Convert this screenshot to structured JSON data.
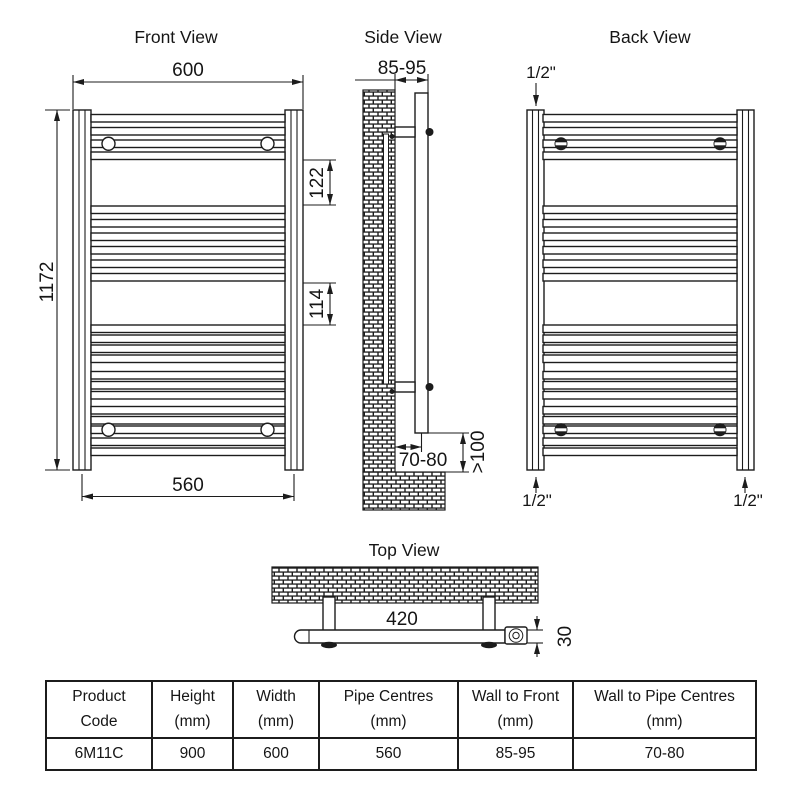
{
  "colors": {
    "line": "#1c1c1c",
    "background": "#ffffff"
  },
  "front_view": {
    "title": "Front View",
    "width_mm": "600",
    "height_mm": "1172",
    "upper_gap_mm": "122",
    "lower_gap_mm": "114",
    "pipe_centres_mm": "560"
  },
  "side_view": {
    "title": "Side View",
    "wall_to_front_mm": "85-95",
    "wall_to_pipe_centres_mm": "70-80",
    "floor_clearance_mm": ">100"
  },
  "back_view": {
    "title": "Back View",
    "top_left_connection": "1/2\"",
    "bottom_left_connection": "1/2\"",
    "bottom_right_connection": "1/2\""
  },
  "top_view": {
    "title": "Top View",
    "bracket_centres_mm": "420",
    "depth_mm": "30"
  },
  "spec_table": {
    "headers": [
      "Product\nCode",
      "Height\n(mm)",
      "Width\n(mm)",
      "Pipe Centres\n(mm)",
      "Wall to Front\n(mm)",
      "Wall to Pipe Centres\n(mm)"
    ],
    "rows": [
      [
        "6M11C",
        "900",
        "600",
        "560",
        "85-95",
        "70-80"
      ]
    ]
  }
}
